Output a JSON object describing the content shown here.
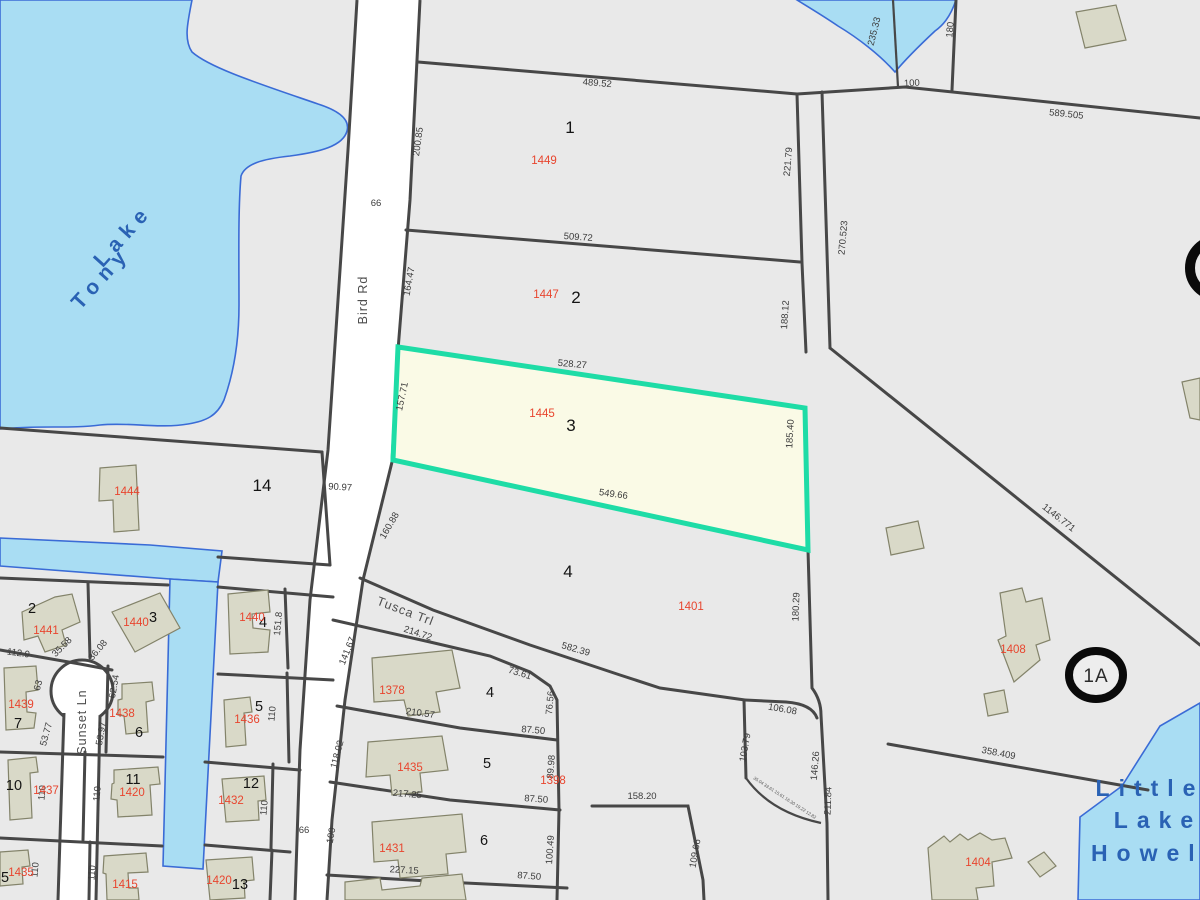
{
  "map_type": "county-parcel-gis-map",
  "colors": {
    "land": "#e9e9e9",
    "water_fill": "#a9ddf3",
    "water_edge": "#3a6bd6",
    "parcel_line": "#474747",
    "building_fill": "#d9d9c8",
    "highlight_outline": "#1edca6",
    "highlight_fill": "#fafae6",
    "parcel_id_red": "#e8452e"
  },
  "selected_parcel": {
    "parcel_id": "1445",
    "lot": "3",
    "dimensions": [
      "528.27",
      "185.40",
      "549.66",
      "157.71"
    ]
  },
  "water_bodies": [
    "Lake Tony",
    "Little Lake Howell"
  ],
  "roads": [
    "Bird Rd",
    "Tusca Trl",
    "Sunset Ln"
  ],
  "marker_1a": "1A",
  "labels": [
    {
      "t": "Lake",
      "x": 128,
      "y": 240,
      "r": -48,
      "c": "water"
    },
    {
      "t": "Tony",
      "x": 106,
      "y": 282,
      "r": -48,
      "c": "water"
    },
    {
      "t": "Little",
      "x": 1150,
      "y": 796,
      "r": 0,
      "c": "water2"
    },
    {
      "t": "Lake",
      "x": 1158,
      "y": 828,
      "r": 0,
      "c": "water2"
    },
    {
      "t": "Howell",
      "x": 1155,
      "y": 861,
      "r": 0,
      "c": "water2"
    },
    {
      "t": "Bird Rd",
      "x": 367,
      "y": 300,
      "r": -90,
      "c": "road"
    },
    {
      "t": "Sunset Ln",
      "x": 86,
      "y": 722,
      "r": -90,
      "c": "road"
    },
    {
      "t": "Tusca Trl",
      "x": 404,
      "y": 615,
      "r": 21,
      "c": "road"
    },
    {
      "t": "1",
      "x": 570,
      "y": 133,
      "r": 0,
      "c": "lot-lg"
    },
    {
      "t": "2",
      "x": 576,
      "y": 303,
      "r": 0,
      "c": "lot-lg"
    },
    {
      "t": "3",
      "x": 571,
      "y": 431,
      "r": 0,
      "c": "lot-lg"
    },
    {
      "t": "4",
      "x": 568,
      "y": 577,
      "r": 0,
      "c": "lot-lg"
    },
    {
      "t": "14",
      "x": 262,
      "y": 491,
      "r": 0,
      "c": "lot-lg"
    },
    {
      "t": "1449",
      "x": 544,
      "y": 164,
      "r": 0,
      "c": "pid"
    },
    {
      "t": "1447",
      "x": 546,
      "y": 298,
      "r": 0,
      "c": "pid"
    },
    {
      "t": "1445",
      "x": 542,
      "y": 417,
      "r": 0,
      "c": "pid"
    },
    {
      "t": "1401",
      "x": 691,
      "y": 610,
      "r": 0,
      "c": "pid"
    },
    {
      "t": "1444",
      "x": 127,
      "y": 495,
      "r": 0,
      "c": "pid"
    },
    {
      "t": "489.52",
      "x": 597,
      "y": 86,
      "r": 5,
      "c": "dim"
    },
    {
      "t": "509.72",
      "x": 578,
      "y": 240,
      "r": 4,
      "c": "dim"
    },
    {
      "t": "528.27",
      "x": 572,
      "y": 367,
      "r": 5,
      "c": "dim"
    },
    {
      "t": "549.66",
      "x": 613,
      "y": 497,
      "r": 8,
      "c": "dim"
    },
    {
      "t": "582.39",
      "x": 575,
      "y": 652,
      "r": 16,
      "c": "dim"
    },
    {
      "t": "200.85",
      "x": 421,
      "y": 142,
      "r": -82,
      "c": "dim"
    },
    {
      "t": "164.47",
      "x": 412,
      "y": 282,
      "r": -80,
      "c": "dim"
    },
    {
      "t": "157.71",
      "x": 405,
      "y": 397,
      "r": -78,
      "c": "dim"
    },
    {
      "t": "160.88",
      "x": 392,
      "y": 527,
      "r": -60,
      "c": "dim"
    },
    {
      "t": "221.79",
      "x": 791,
      "y": 162,
      "r": -85,
      "c": "dim"
    },
    {
      "t": "188.12",
      "x": 788,
      "y": 315,
      "r": -86,
      "c": "dim"
    },
    {
      "t": "185.40",
      "x": 793,
      "y": 434,
      "r": -87,
      "c": "dim"
    },
    {
      "t": "180.29",
      "x": 799,
      "y": 607,
      "r": -88,
      "c": "dim"
    },
    {
      "t": "235.33",
      "x": 877,
      "y": 32,
      "r": -76,
      "c": "dim"
    },
    {
      "t": "180",
      "x": 953,
      "y": 30,
      "r": -85,
      "c": "dim"
    },
    {
      "t": "100",
      "x": 912,
      "y": 86,
      "r": -3,
      "c": "dim"
    },
    {
      "t": "589.505",
      "x": 1066,
      "y": 117,
      "r": 6,
      "c": "dim"
    },
    {
      "t": "270.523",
      "x": 846,
      "y": 238,
      "r": -85,
      "c": "dim"
    },
    {
      "t": "1146.771",
      "x": 1057,
      "y": 520,
      "r": 38,
      "c": "dim"
    },
    {
      "t": "358.409",
      "x": 998,
      "y": 756,
      "r": 11,
      "c": "dim"
    },
    {
      "t": "90.97",
      "x": 340,
      "y": 490,
      "r": 3,
      "c": "dim"
    },
    {
      "t": "66",
      "x": 376,
      "y": 206,
      "r": 0,
      "c": "dim"
    },
    {
      "t": "66",
      "x": 304,
      "y": 833,
      "r": 0,
      "c": "dim"
    },
    {
      "t": "100",
      "x": 334,
      "y": 836,
      "r": -80,
      "c": "dim"
    },
    {
      "t": "214.72",
      "x": 417,
      "y": 636,
      "r": 18,
      "c": "dim"
    },
    {
      "t": "141.67",
      "x": 350,
      "y": 652,
      "r": -68,
      "c": "dim"
    },
    {
      "t": "73.61",
      "x": 519,
      "y": 676,
      "r": 17,
      "c": "dim"
    },
    {
      "t": "76.56",
      "x": 553,
      "y": 703,
      "r": -85,
      "c": "dim"
    },
    {
      "t": "87.50",
      "x": 533,
      "y": 733,
      "r": 5,
      "c": "dim"
    },
    {
      "t": "210.57",
      "x": 420,
      "y": 716,
      "r": 8,
      "c": "dim"
    },
    {
      "t": "118.02",
      "x": 340,
      "y": 755,
      "r": -75,
      "c": "dim"
    },
    {
      "t": "217.25",
      "x": 407,
      "y": 797,
      "r": 5,
      "c": "dim"
    },
    {
      "t": "89.98",
      "x": 554,
      "y": 767,
      "r": -86,
      "c": "dim"
    },
    {
      "t": "87.50",
      "x": 536,
      "y": 802,
      "r": 4,
      "c": "dim"
    },
    {
      "t": "227.15",
      "x": 404,
      "y": 873,
      "r": 3,
      "c": "dim"
    },
    {
      "t": "100.49",
      "x": 553,
      "y": 850,
      "r": -86,
      "c": "dim"
    },
    {
      "t": "87.50",
      "x": 529,
      "y": 879,
      "r": 4,
      "c": "dim"
    },
    {
      "t": "158.20",
      "x": 642,
      "y": 799,
      "r": 0,
      "c": "dim"
    },
    {
      "t": "106.08",
      "x": 782,
      "y": 712,
      "r": 10,
      "c": "dim"
    },
    {
      "t": "103.79",
      "x": 748,
      "y": 748,
      "r": -80,
      "c": "dim"
    },
    {
      "t": "146.26",
      "x": 818,
      "y": 766,
      "r": -85,
      "c": "dim"
    },
    {
      "t": "211.84",
      "x": 831,
      "y": 801,
      "r": -88,
      "c": "dim"
    },
    {
      "t": "109.66",
      "x": 698,
      "y": 854,
      "r": -80,
      "c": "dim"
    },
    {
      "t": "35.04  33.61  15.61  16.30  19.22 12.82",
      "x": 784,
      "y": 799,
      "r": 33,
      "c": "tiny"
    },
    {
      "t": "112.9",
      "x": 18,
      "y": 656,
      "r": 8,
      "c": "dim"
    },
    {
      "t": "35.58",
      "x": 64,
      "y": 649,
      "r": -45,
      "c": "dim"
    },
    {
      "t": "36.08",
      "x": 100,
      "y": 652,
      "r": -50,
      "c": "dim"
    },
    {
      "t": "151.8",
      "x": 281,
      "y": 624,
      "r": -85,
      "c": "dim"
    },
    {
      "t": "63",
      "x": 41,
      "y": 686,
      "r": -75,
      "c": "dim"
    },
    {
      "t": "53.77",
      "x": 49,
      "y": 735,
      "r": -75,
      "c": "dim"
    },
    {
      "t": "62.54",
      "x": 117,
      "y": 687,
      "r": -80,
      "c": "dim"
    },
    {
      "t": "53.97",
      "x": 104,
      "y": 734,
      "r": -80,
      "c": "dim"
    },
    {
      "t": "110",
      "x": 275,
      "y": 714,
      "r": -85,
      "c": "dim"
    },
    {
      "t": "110",
      "x": 45,
      "y": 793,
      "r": -85,
      "c": "dim"
    },
    {
      "t": "110",
      "x": 100,
      "y": 794,
      "r": -85,
      "c": "dim"
    },
    {
      "t": "110",
      "x": 267,
      "y": 808,
      "r": -85,
      "c": "dim"
    },
    {
      "t": "110",
      "x": 38,
      "y": 870,
      "r": -85,
      "c": "dim"
    },
    {
      "t": "110",
      "x": 95,
      "y": 873,
      "r": -85,
      "c": "dim"
    },
    {
      "t": "2",
      "x": 32,
      "y": 613,
      "r": 0,
      "c": "lot"
    },
    {
      "t": "3",
      "x": 153,
      "y": 622,
      "r": 0,
      "c": "lot"
    },
    {
      "t": "4",
      "x": 263,
      "y": 627,
      "r": 0,
      "c": "lot"
    },
    {
      "t": "7",
      "x": 18,
      "y": 728,
      "r": 0,
      "c": "lot"
    },
    {
      "t": "6",
      "x": 139,
      "y": 737,
      "r": 0,
      "c": "lot"
    },
    {
      "t": "5",
      "x": 259,
      "y": 711,
      "r": 0,
      "c": "lot"
    },
    {
      "t": "10",
      "x": 14,
      "y": 790,
      "r": 0,
      "c": "lot"
    },
    {
      "t": "11",
      "x": 133,
      "y": 784,
      "r": 0,
      "c": "lot"
    },
    {
      "t": "12",
      "x": 251,
      "y": 788,
      "r": 0,
      "c": "lot"
    },
    {
      "t": "5",
      "x": 5,
      "y": 882,
      "r": 0,
      "c": "lot"
    },
    {
      "t": "13",
      "x": 240,
      "y": 889,
      "r": 0,
      "c": "lot"
    },
    {
      "t": "4",
      "x": 490,
      "y": 697,
      "r": 0,
      "c": "lot"
    },
    {
      "t": "5",
      "x": 487,
      "y": 768,
      "r": 0,
      "c": "lot"
    },
    {
      "t": "6",
      "x": 484,
      "y": 845,
      "r": 0,
      "c": "lot"
    },
    {
      "t": "1441",
      "x": 46,
      "y": 634,
      "r": 0,
      "c": "pid"
    },
    {
      "t": "1440",
      "x": 136,
      "y": 626,
      "r": 0,
      "c": "pid"
    },
    {
      "t": "1440",
      "x": 252,
      "y": 621,
      "r": 0,
      "c": "pid"
    },
    {
      "t": "1439",
      "x": 21,
      "y": 708,
      "r": 0,
      "c": "pid"
    },
    {
      "t": "1438",
      "x": 122,
      "y": 717,
      "r": 0,
      "c": "pid"
    },
    {
      "t": "1436",
      "x": 247,
      "y": 723,
      "r": 0,
      "c": "pid"
    },
    {
      "t": "1437",
      "x": 46,
      "y": 794,
      "r": 0,
      "c": "pid"
    },
    {
      "t": "1420",
      "x": 132,
      "y": 796,
      "r": 0,
      "c": "pid"
    },
    {
      "t": "1432",
      "x": 231,
      "y": 804,
      "r": 0,
      "c": "pid"
    },
    {
      "t": "1435",
      "x": 21,
      "y": 876,
      "r": 0,
      "c": "pid"
    },
    {
      "t": "1415",
      "x": 125,
      "y": 888,
      "r": 0,
      "c": "pid"
    },
    {
      "t": "1420",
      "x": 219,
      "y": 884,
      "r": 0,
      "c": "pid"
    },
    {
      "t": "1378",
      "x": 392,
      "y": 694,
      "r": 0,
      "c": "pid"
    },
    {
      "t": "1435",
      "x": 410,
      "y": 771,
      "r": 0,
      "c": "pid"
    },
    {
      "t": "1398",
      "x": 553,
      "y": 784,
      "r": 0,
      "c": "pid"
    },
    {
      "t": "1431",
      "x": 392,
      "y": 852,
      "r": 0,
      "c": "pid"
    },
    {
      "t": "1404",
      "x": 978,
      "y": 866,
      "r": 0,
      "c": "pid"
    },
    {
      "t": "1408",
      "x": 1013,
      "y": 653,
      "r": 0,
      "c": "pid"
    },
    {
      "t": "1A",
      "x": 1096,
      "y": 682,
      "r": 0,
      "c": "marker"
    }
  ]
}
